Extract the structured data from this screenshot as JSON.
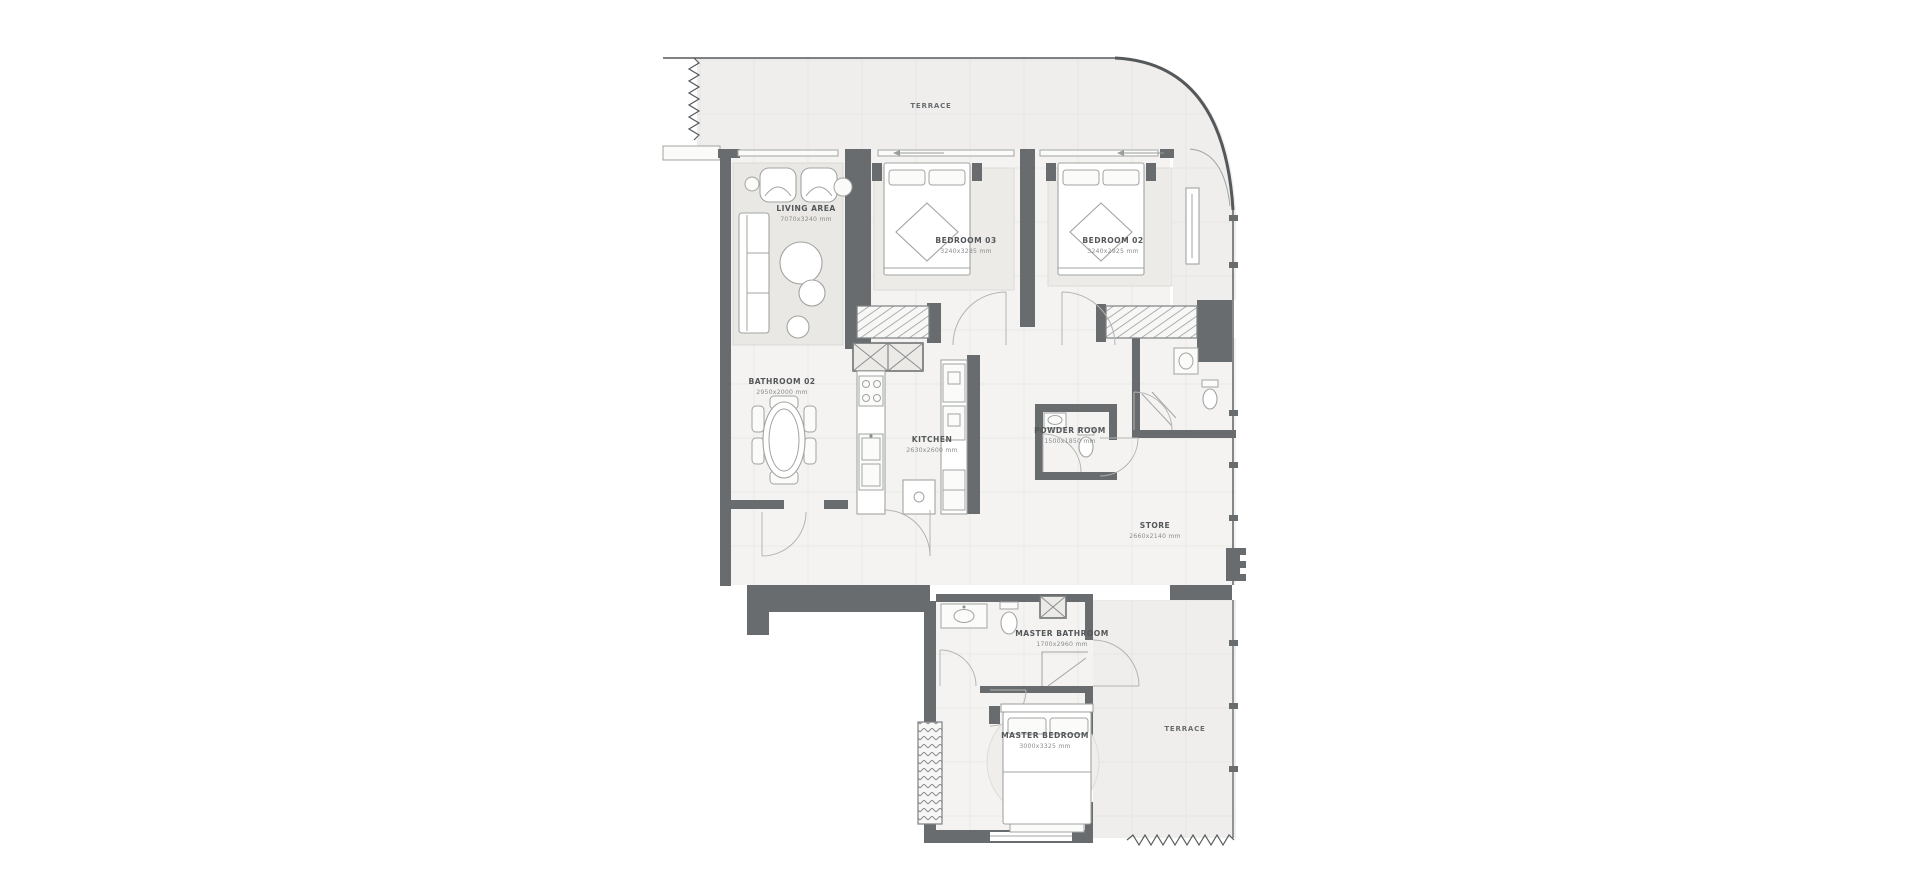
{
  "colors": {
    "wall": "#686c6e",
    "floor": "#f4f3f1",
    "terrace": "#efeeec",
    "rug": "#e9e8e4",
    "line": "#a2a4a1",
    "grid": "#e6e5e2",
    "text": "#54575a",
    "dim": "#8a8d8f"
  },
  "rooms": {
    "terrace_top": {
      "name": "TERRACE"
    },
    "living": {
      "name": "LIVING AREA",
      "dims": "7070x3240 mm"
    },
    "bedroom3": {
      "name": "BEDROOM 03",
      "dims": "3240x3285 mm"
    },
    "bedroom2": {
      "name": "BEDROOM 02",
      "dims": "3240x2925 mm"
    },
    "bathroom2": {
      "name": "BATHROOM 02",
      "dims": "2950x2000 mm"
    },
    "kitchen": {
      "name": "KITCHEN",
      "dims": "2630x2600 mm"
    },
    "powder": {
      "name": "POWDER ROOM",
      "dims": "1500x1850 mm"
    },
    "store": {
      "name": "STORE",
      "dims": "2660x2140 mm"
    },
    "master_bath": {
      "name": "MASTER BATHROOM",
      "dims": "1700x2960 mm"
    },
    "master_bed": {
      "name": "MASTER BEDROOM",
      "dims": "3000x3325 mm"
    },
    "terrace_right": {
      "name": "TERRACE"
    }
  }
}
